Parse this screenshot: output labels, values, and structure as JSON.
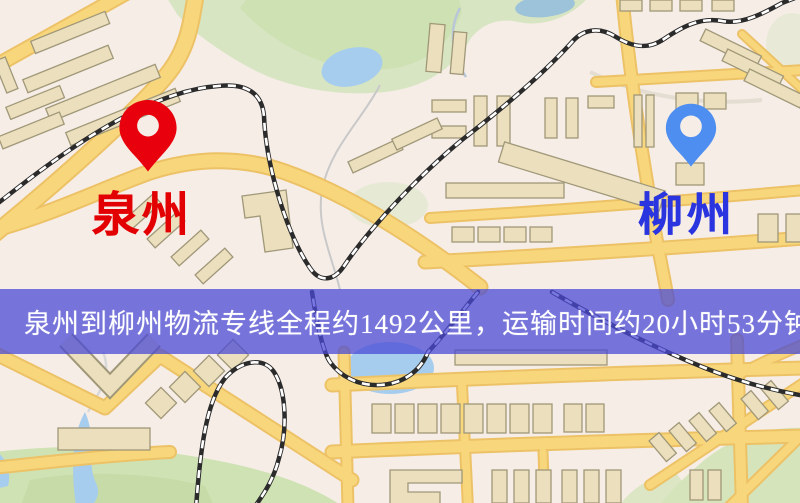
{
  "banner": {
    "text": "泉州到柳州物流专线全程约1492公里，运输时间约20小时53分钟.",
    "background_color": "#4949d5",
    "text_color": "#ffffff"
  },
  "route": {
    "origin": "泉州",
    "destination": "柳州",
    "distance_text": "约1492公里",
    "duration_text": "约20小时53分钟"
  },
  "pins": {
    "origin": {
      "label": "泉州",
      "label_color": "#e30003",
      "pin_color": "#e8000d",
      "icon": "map-pin"
    },
    "destination": {
      "label": "柳州",
      "label_color": "#2b35df",
      "pin_color": "#4d8ef0",
      "icon": "map-pin"
    }
  },
  "map": {
    "colors": {
      "background": "#f5eee6",
      "road_fill": "#f8d77c",
      "road_casing": "#edc266",
      "park_green": "#d8e5c3",
      "water_blue": "#a6cdee",
      "building_tan": "#ebdfbd",
      "railway_dark": "#2b2b2b"
    }
  }
}
